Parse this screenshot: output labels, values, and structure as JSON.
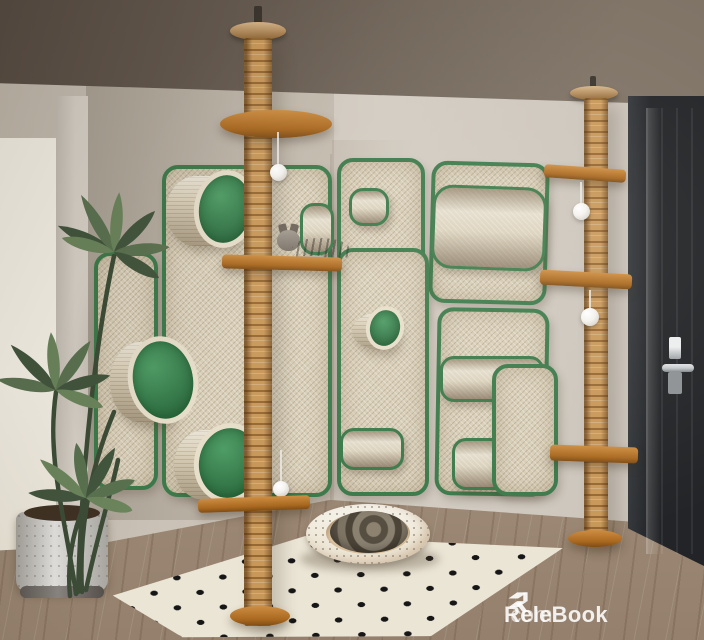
{
  "watermark": {
    "brand": "ReleBook",
    "suffix": ".com"
  },
  "scene": {
    "description": "Corner cat climbing wall: sisal scratcher panels with green trim, two floor-to-ceiling sisal poles with wooden platforms, drum perches, hanging white balls, a tabby cat lounging on a platform, a cat sleeping in a round bed on a diamond-pattern rug, a potted plant and a dark entry door."
  },
  "palette": {
    "ceil1": "#574c43",
    "ceil2": "#7f7366",
    "wallL1": "#aba296",
    "wallL2": "#c3baae",
    "wallR": "#d3ccc2",
    "wallR2": "#c9c2b8",
    "bright": "#f6f2e8",
    "column": "#d8d2c9",
    "floor1": "#b4a18d",
    "floor2": "#94806c",
    "grain": "rgba(90,66,48,0.22)",
    "rug": "#ebe5d5",
    "rugDot": "#161616",
    "sisal": "#c8985a",
    "panel": "#d9cfb8",
    "green": "#3c7a4a",
    "greenFace1": "#4f9d66",
    "greenFace2": "#2e6e41",
    "wood1": "#cd8d42",
    "wood2": "#a9681f",
    "wood3": "#7e4c15",
    "door1": "#222427",
    "door2": "#43474c",
    "silver": "#c6c9cc",
    "ball": "#f4f2ee",
    "pot1": "#cbc9c4",
    "bed": "#efe8d8",
    "bedInner": "#e2c9a6",
    "cat1": "#8d8478",
    "cat2": "#57503f",
    "wm": "rgba(255,255,255,0.88)",
    "wm2": "rgba(255,255,255,0.62)"
  }
}
